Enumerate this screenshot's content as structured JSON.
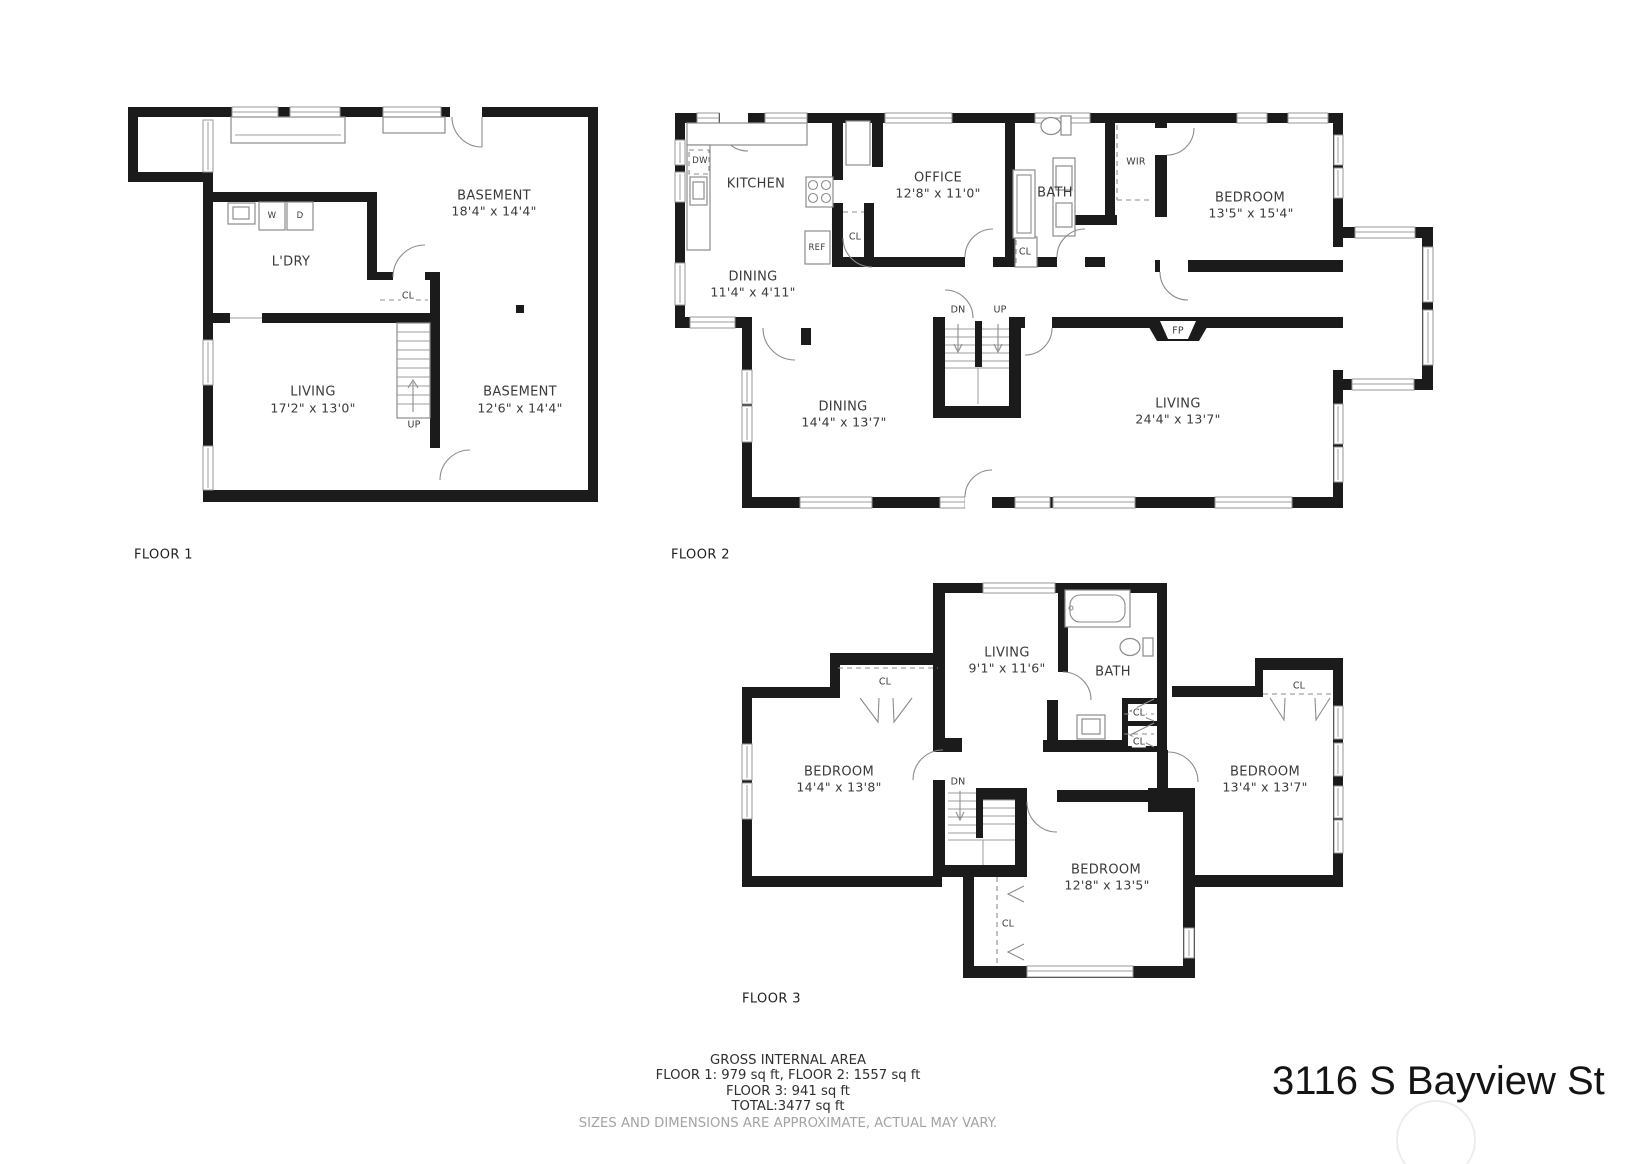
{
  "floor1": {
    "title": "FLOOR 1",
    "basement_upper": "BASEMENT",
    "basement_upper_dims": "18'4\" x 14'4\"",
    "laundry": "L'DRY",
    "closet": "CL",
    "living": "LIVING",
    "living_dims": "17'2\" x 13'0\"",
    "basement_lower": "BASEMENT",
    "basement_lower_dims": "12'6\" x 14'4\"",
    "up": "UP",
    "washer": "W",
    "dryer": "D"
  },
  "floor2": {
    "title": "FLOOR 2",
    "kitchen": "KITCHEN",
    "dishwasher": "DW",
    "fridge": "REF",
    "closet_kitchen": "CL",
    "office": "OFFICE",
    "office_dims": "12'8\" x 11'0\"",
    "bath": "BATH",
    "closet_hall": "CL",
    "walk_in_robe": "WIR",
    "bedroom": "BEDROOM",
    "bedroom_dims": "13'5\" x 15'4\"",
    "dining_upper": "DINING",
    "dining_upper_dims": "11'4\" x 4'11\"",
    "down": "DN",
    "up": "UP",
    "fireplace": "FP",
    "dining": "DINING",
    "dining_dims": "14'4\" x 13'7\"",
    "living": "LIVING",
    "living_dims": "24'4\" x 13'7\""
  },
  "floor3": {
    "title": "FLOOR 3",
    "living": "LIVING",
    "living_dims": "9'1\" x 11'6\"",
    "bath": "BATH",
    "closet_left": "CL",
    "closet_right_upper": "CL",
    "closet_right_lower": "CL",
    "closet_top_right": "CL",
    "closet_bottom": "CL",
    "bedroom_left": "BEDROOM",
    "bedroom_left_dims": "14'4\" x 13'8\"",
    "bedroom_right": "BEDROOM",
    "bedroom_right_dims": "13'4\" x 13'7\"",
    "bedroom_middle": "BEDROOM",
    "bedroom_middle_dims": "12'8\" x 13'5\"",
    "down": "DN"
  },
  "footer": {
    "heading": "GROSS INTERNAL AREA",
    "areas_line1": "FLOOR 1: 979 sq ft, FLOOR 2: 1557 sq ft",
    "areas_line2": "FLOOR 3: 941 sq ft",
    "total": "TOTAL:3477 sq ft",
    "disclaimer": "SIZES AND DIMENSIONS ARE APPROXIMATE, ACTUAL MAY VARY."
  },
  "address": "3116 S Bayview St"
}
